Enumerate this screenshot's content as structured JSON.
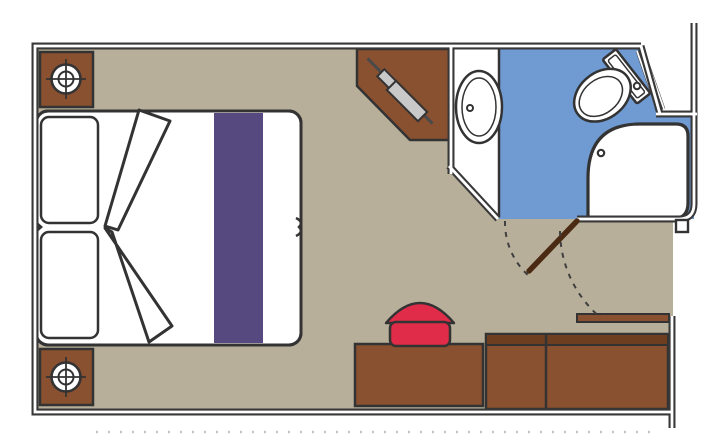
{
  "meta": {
    "title": "Cruise ship stateroom floor plan",
    "description": "Top-down architectural plan of an interior cabin: double bed with runner, two nightstands with ceiling-light symbols, TV cabinet, desk with stool, wardrobe, luggage shelf, and en-suite bathroom (sink, toilet, shower) with door swing arcs. No text labels are rendered in the plan."
  },
  "colors": {
    "background": "#ffffff",
    "wall": "#383838",
    "wall_core": "#ffffff",
    "outline": "#333333",
    "floor": "#b7af9a",
    "bathroom_floor": "#6f9ad2",
    "wood": "#8a5130",
    "wood_dark": "#6e3e20",
    "linen": "#ffffff",
    "fixture": "#ffffff",
    "runner": "#55497f",
    "stool_red": "#e02c48",
    "tv_gray": "#c9c9c9",
    "tv_rod": "#4a4a4a",
    "door_leaf": "#4a2a12",
    "dash": "#3f3f3f",
    "corridor_dash": "#c9c5bc"
  },
  "plan": {
    "rooms": [
      {
        "name": "cabin",
        "floor": "tan"
      },
      {
        "name": "bathroom",
        "floor": "blue"
      }
    ],
    "fixtures": [
      "double-bed",
      "pillow-left",
      "pillow-right",
      "bed-runner",
      "folded-blanket",
      "nightstand-ceiling-light-top",
      "nightstand-ceiling-light-bottom",
      "tv-cabinet",
      "tv-screen",
      "desk",
      "stool",
      "wardrobe",
      "luggage-shelf",
      "sink-counter",
      "sink-basin",
      "toilet",
      "shower",
      "bathroom-door",
      "bathroom-door-swing",
      "entry-door-swing",
      "door-jamb"
    ],
    "icons": [
      {
        "name": "ceiling-light-icon",
        "glyph": "crosshair-target-circle"
      },
      {
        "name": "tv-screen-icon",
        "glyph": "diagonal-bars"
      }
    ]
  }
}
